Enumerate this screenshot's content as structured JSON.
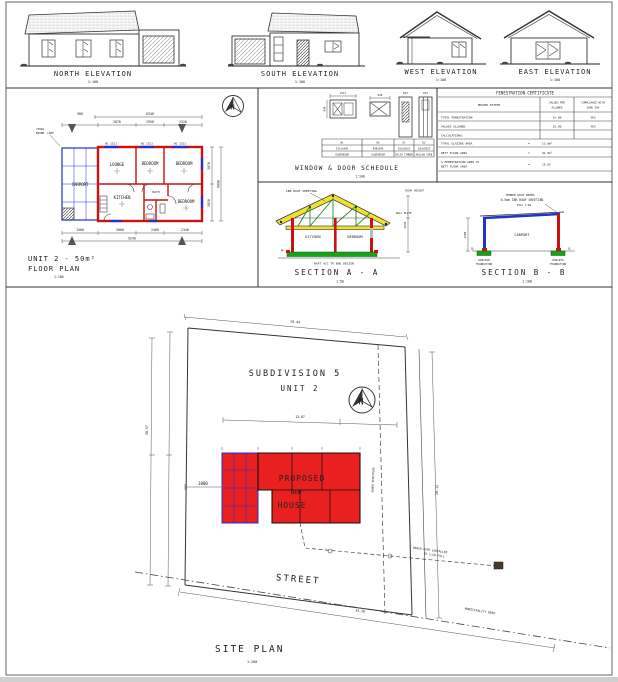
{
  "compass": {
    "label": "N"
  },
  "colors": {
    "wall_red": "#cc1111",
    "carport_blue": "#2233cc",
    "truss_yellow": "#f0e130",
    "truss_green": "#2a8a2a",
    "slab_green": "#17a317",
    "site_red": "#e92020",
    "note_maroon": "#8b1a1a"
  },
  "elevations": [
    {
      "label": "NORTH ELEVATION",
      "scale": "1:100"
    },
    {
      "label": "SOUTH ELEVATION",
      "scale": "1:100"
    },
    {
      "label": "WEST ELEVATION",
      "scale": "1:100"
    },
    {
      "label": "EAST ELEVATION",
      "scale": "1:100"
    }
  ],
  "floor_plan": {
    "title": "UNIT 2 - 50m²",
    "subtitle": "FLOOR PLAN",
    "scale": "1:100",
    "rooms": [
      "LOUNGE",
      "BEDROOM",
      "BEDROOM",
      "KITCHEN",
      "BATH",
      "BEDROOM",
      "CARPORT"
    ],
    "window_tags": [
      "W1 1511",
      "W1 1511",
      "W1 1511"
    ],
    "note1": "750mm",
    "note2": "BOUND. LINE",
    "dims": {
      "top_left": "900",
      "top_total": "8340",
      "row2": [
        "2870",
        "2950",
        "2520"
      ],
      "bottom": [
        "1500",
        "3000",
        "2400",
        "2340"
      ],
      "bottom_total": "9240",
      "right": [
        "3070",
        "3020"
      ],
      "right_total": "6090"
    }
  },
  "schedule": {
    "title": "WINDOW & DOOR SCHEDULE",
    "scale": "1:100",
    "items": [
      {
        "id": "W1",
        "size": "1511x949",
        "type": "ALUMINIUM",
        "dim": "1511"
      },
      {
        "id": "W2",
        "size": "949x949",
        "type": "ALUMINIUM",
        "dim": "949"
      },
      {
        "id": "D1",
        "size": "813x2032",
        "type": "SOLID TIMBER",
        "dim": "813"
      },
      {
        "id": "D2",
        "size": "813x2032",
        "type": "HOLLOW CORE",
        "dim": "813"
      }
    ]
  },
  "fenestration": {
    "title": "FENESTRATION CERTIFICATE",
    "col_item": "PROVED EXTENT",
    "col_val_1": "VALUES PER",
    "col_val_2": "ALLOWED",
    "col_comp_1": "COMPLIANCE WITH",
    "col_comp_2": "SANS 204",
    "rows": [
      {
        "label": "TOTAL FENESTRATION",
        "value": "15.00",
        "comp": "YES"
      },
      {
        "label": "VALUES ALLOWED",
        "value": "15.00",
        "comp": "YES"
      }
    ],
    "calc_heading": "CALCULATIONS:",
    "calcs": [
      {
        "label": "TOTAL GLAZING AREA",
        "eq": "=",
        "value": "13.0m²"
      },
      {
        "label": "NETT FLOOR AREA",
        "eq": "=",
        "value": "41.0m²"
      },
      {
        "label": "% FENESTRATION AREA TO",
        "label2": "NETT FLOOR AREA",
        "eq": "=",
        "value": "15.05"
      }
    ]
  },
  "section_a": {
    "title": "SECTION A - A",
    "scale": "1:50",
    "roof_note": "IBR ROOF SHEETING",
    "right_note": "ROOF HEIGHT",
    "wallplate_note": "WALL PLATE",
    "rooms": [
      "KITCHEN",
      "BEDROOM"
    ],
    "slab_note": "RAFT ACC TO ENG DESIGN",
    "dim": "2595",
    "gl": "GL"
  },
  "section_b": {
    "title": "SECTION B - B",
    "scale": "1:100",
    "note1": "TIMBER ROOF BEAMS",
    "note2": "0.5mm IBR ROOF SHEETING",
    "note3": "FALL 1:60",
    "room": "CARPORT",
    "foundation1": "600x250",
    "foundation2": "FOUNDATION",
    "dim": "2400",
    "gl": "GL"
  },
  "site_plan": {
    "title": "SITE PLAN",
    "scale": "1:200",
    "subdivision": "SUBDIVISION 5",
    "unit": "UNIT 2",
    "house_line1": "PROPOSED",
    "house_line2": "NEW",
    "house_line3": "HOUSE",
    "street": "STREET",
    "boundary_label": "MUNICIPALITY BDRY",
    "servitude_label": "SEWER SERVITUDE",
    "drain_note1": "DRAIN PIPE INSTALLED",
    "drain_note2": "TO 1:60 FALL",
    "dims": {
      "offset": "3000",
      "top": "18.44",
      "left": "30.57",
      "mid": "13.87",
      "right": "20.12",
      "bottom": "24.38"
    }
  }
}
